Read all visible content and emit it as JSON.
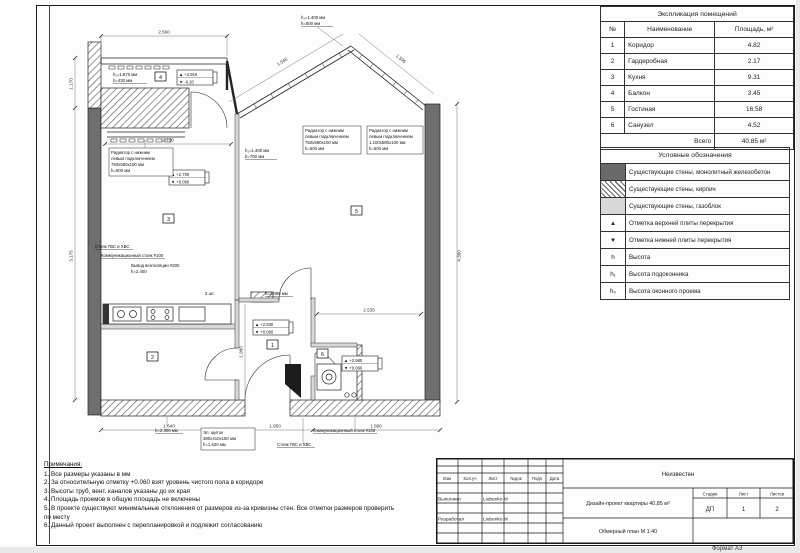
{
  "sheet": {
    "format_label": "Формат А3"
  },
  "explication": {
    "title": "Экспликация помещений",
    "col_num": "№",
    "col_name": "Наименование",
    "col_area": "Площадь, м²",
    "rows": [
      {
        "num": "1",
        "name": "Коридор",
        "area": "4.82"
      },
      {
        "num": "2",
        "name": "Гардеробная",
        "area": "2.17"
      },
      {
        "num": "3",
        "name": "Кухня",
        "area": "9.31"
      },
      {
        "num": "4",
        "name": "Балкон",
        "area": "3.45"
      },
      {
        "num": "5",
        "name": "Гостиная",
        "area": "16.58"
      },
      {
        "num": "6",
        "name": "Санузел",
        "area": "4.52"
      }
    ],
    "total_label": "Всего",
    "total_value": "40.85 м²"
  },
  "legend": {
    "title": "Условные обозначения",
    "rows": [
      {
        "symbol": "",
        "text": "Существующие стены, монолитный железобетон"
      },
      {
        "symbol": "",
        "text": "Существующие стены, кирпич"
      },
      {
        "symbol": "",
        "text": "Существующие стены, газоблок"
      },
      {
        "symbol": "▲",
        "text": "Отметка верхней плиты перекрытия"
      },
      {
        "symbol": "▼",
        "text": "Отметка нижней плиты перекрытия"
      },
      {
        "symbol": "h",
        "text": "Высота"
      },
      {
        "symbol": "h₁",
        "text": "Высота подоконника"
      },
      {
        "symbol": "h₀",
        "text": "Высота оконного проема"
      }
    ]
  },
  "notes": {
    "title": "Примечания:",
    "items": [
      "1. Все размеры указаны в мм",
      "2. За относительную отметку +0.060 взят уровень чистого пола в коридоре",
      "3. Высоты труб, вент. каналов указаны до их края",
      "4. Площадь проемов в общую площадь не включены",
      "5. В проекте существуют минимальные отклонения от размеров из-за кривизны стен. Все отметки размеров проверить по месту",
      "6. Данный проект выполнен с перепланировкой и подлежит согласованию"
    ]
  },
  "titleblock": {
    "company": "Неизвестен",
    "cols": [
      "Изм",
      "Кол.уч",
      "Лист",
      "№док",
      "Подп",
      "Дата"
    ],
    "role1": "Выполнил",
    "name1": "Liubenko М",
    "role2": "Разработал",
    "name2": "Liubenko М",
    "project": "Дизайн-проект квартиры 40,85 м²",
    "drawing": "Обмерный план М 1:40",
    "stage_label": "Стадия",
    "sheet_label": "Лист",
    "sheets_label": "Листов",
    "stage": "ДП",
    "sheet": "1",
    "sheets": "2"
  },
  "plan": {
    "room_numbers": {
      "corridor": "1",
      "wardrobe": "2",
      "kitchen": "3",
      "balcony": "4",
      "living": "5",
      "bathroom": "6"
    },
    "dims": {
      "top": "2.560",
      "bay_left": "1.545",
      "bay_right": "1.595",
      "left_balcony": "1.170",
      "left_total": "3.175",
      "right": "4.380",
      "bottom_left": "1.640",
      "bottom_mid": "1.950",
      "bottom_right": "1.890",
      "living_width": "2.535",
      "corridor_height": "1.980",
      "kitchen_width": "2.730"
    },
    "levels": {
      "balcony": {
        "up": "▲ +2.910",
        "down": "▼ -0.20"
      },
      "kitchen": {
        "up": "▲ +2.700",
        "down": "▼ +0.060"
      },
      "corridor": {
        "up": "▲ +2.930",
        "down": "▼ +0.060"
      },
      "living": {
        "up": "▲ +2.980",
        "down": "▼ +0.060"
      }
    },
    "annotations": {
      "balcony_window": [
        "h₁=1.870 мм",
        "h=430 мм"
      ],
      "kitchen_radiator": [
        "Радиатор с нижним",
        "левым подключением",
        "750х580х100 мм",
        "h=500 мм"
      ],
      "kitchen_window": [
        "h₁=1.400 мм",
        "b=700 мм"
      ],
      "bay_window": [
        "h₁=1.400 мм",
        "h=500 мм"
      ],
      "bay_radiator_left": [
        "Радиатор с нижним",
        "левым подключением",
        "750х580х100 мм",
        "h=500 мм"
      ],
      "bay_radiator_right": [
        "Радиатор с нижним",
        "левым подключением",
        "1.100х580х100 мм",
        "h=500 мм"
      ],
      "riser_water": "Стояк ГВС и ХВС",
      "riser_comm": "Коммуникационный стояк #100",
      "vent": [
        "Вывод вентиляции #200",
        "h=2.400"
      ],
      "qty": "2 шт.",
      "h_2080": "h=2.080 мм",
      "h_2300": "h=2.300 мм",
      "el_shield": [
        "Эл. щиток",
        "380х410х150 мм",
        "h=1.620 мм"
      ],
      "riser_water2": "Стояк ГВС и ХВС",
      "riser_comm2": "Коммуникационный стояк #100"
    }
  }
}
